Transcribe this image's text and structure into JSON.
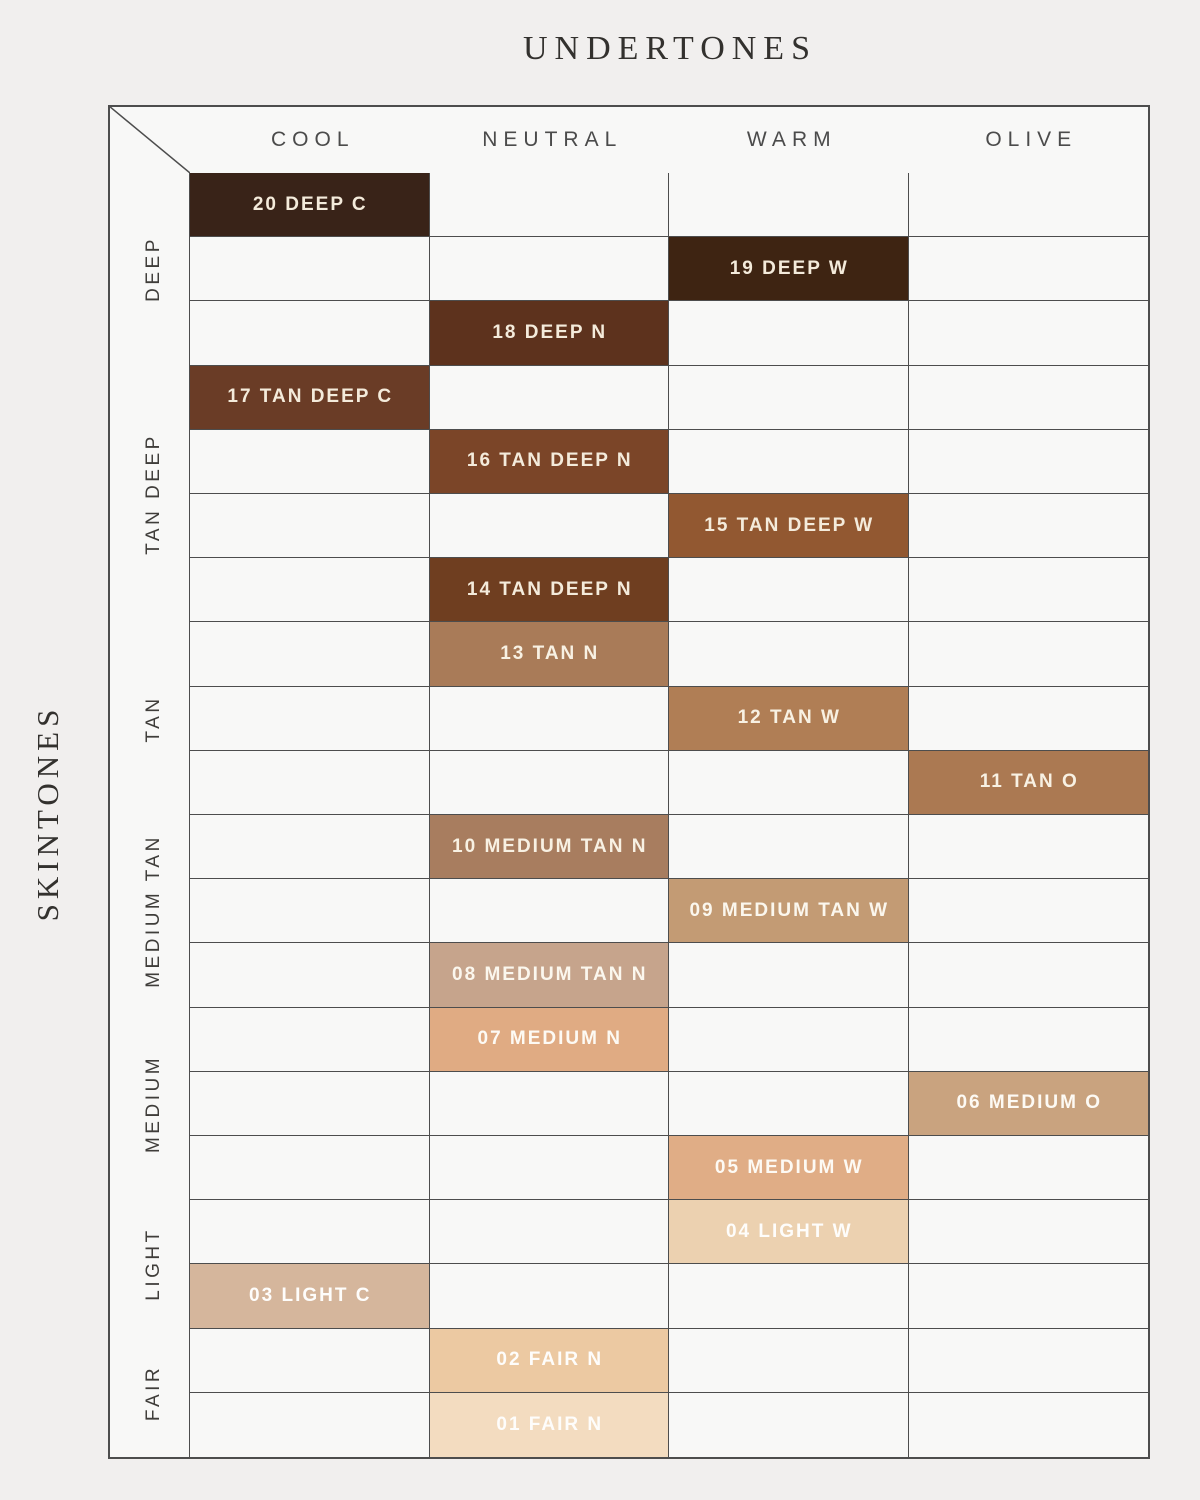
{
  "page": {
    "title": "UNDERTONES",
    "side_title": "SKINTONES"
  },
  "undertones": [
    "COOL",
    "NEUTRAL",
    "WARM",
    "OLIVE"
  ],
  "skintone_groups": [
    {
      "label": "DEEP",
      "rows": 3
    },
    {
      "label": "TAN DEEP",
      "rows": 4
    },
    {
      "label": "TAN",
      "rows": 3
    },
    {
      "label": "MEDIUM TAN",
      "rows": 3
    },
    {
      "label": "MEDIUM",
      "rows": 3
    },
    {
      "label": "LIGHT",
      "rows": 2
    },
    {
      "label": "FAIR",
      "rows": 2
    }
  ],
  "chart_data": {
    "type": "table",
    "title": "UNDERTONES",
    "column_axis_label": "UNDERTONES",
    "row_axis_label": "SKINTONES",
    "columns": [
      "COOL",
      "NEUTRAL",
      "WARM",
      "OLIVE"
    ],
    "row_groups": [
      "DEEP",
      "TAN DEEP",
      "TAN",
      "MEDIUM TAN",
      "MEDIUM",
      "LIGHT",
      "FAIR"
    ],
    "cells": [
      {
        "shade": "20 DEEP C",
        "skintone": "DEEP",
        "undertone": "COOL",
        "swatch": "#392318",
        "label_color": "#f4ebdb"
      },
      {
        "shade": "19 DEEP W",
        "skintone": "DEEP",
        "undertone": "WARM",
        "swatch": "#3e2412",
        "label_color": "#f4ebdb"
      },
      {
        "shade": "18 DEEP N",
        "skintone": "DEEP",
        "undertone": "NEUTRAL",
        "swatch": "#5d321d",
        "label_color": "#f4ebdb"
      },
      {
        "shade": "17 TAN DEEP C",
        "skintone": "TAN DEEP",
        "undertone": "COOL",
        "swatch": "#6a3c26",
        "label_color": "#f4ebdb"
      },
      {
        "shade": "16 TAN DEEP N",
        "skintone": "TAN DEEP",
        "undertone": "NEUTRAL",
        "swatch": "#7b4528",
        "label_color": "#f4ebdb"
      },
      {
        "shade": "15 TAN DEEP W",
        "skintone": "TAN DEEP",
        "undertone": "WARM",
        "swatch": "#925831",
        "label_color": "#f4ebdb"
      },
      {
        "shade": "14 TAN DEEP N",
        "skintone": "TAN DEEP",
        "undertone": "NEUTRAL",
        "swatch": "#6f3e20",
        "label_color": "#f4ebdb"
      },
      {
        "shade": "13 TAN N",
        "skintone": "TAN",
        "undertone": "NEUTRAL",
        "swatch": "#a97b58",
        "label_color": "#f8f1e3"
      },
      {
        "shade": "12 TAN W",
        "skintone": "TAN",
        "undertone": "WARM",
        "swatch": "#b07e55",
        "label_color": "#f8f1e3"
      },
      {
        "shade": "11 TAN O",
        "skintone": "TAN",
        "undertone": "OLIVE",
        "swatch": "#ab7952",
        "label_color": "#f8f1e3"
      },
      {
        "shade": "10 MEDIUM TAN N",
        "skintone": "MEDIUM TAN",
        "undertone": "NEUTRAL",
        "swatch": "#a87d5f",
        "label_color": "#f8f1e3"
      },
      {
        "shade": "09 MEDIUM TAN W",
        "skintone": "MEDIUM TAN",
        "undertone": "WARM",
        "swatch": "#c39b74",
        "label_color": "#fbf7ee"
      },
      {
        "shade": "08 MEDIUM TAN N",
        "skintone": "MEDIUM TAN",
        "undertone": "NEUTRAL",
        "swatch": "#c6a48c",
        "label_color": "#fbf7ee"
      },
      {
        "shade": "07 MEDIUM N",
        "skintone": "MEDIUM",
        "undertone": "NEUTRAL",
        "swatch": "#e0ab83",
        "label_color": "#fdfaf4"
      },
      {
        "shade": "06 MEDIUM O",
        "skintone": "MEDIUM",
        "undertone": "OLIVE",
        "swatch": "#c9a37f",
        "label_color": "#fdfaf4"
      },
      {
        "shade": "05 MEDIUM W",
        "skintone": "MEDIUM",
        "undertone": "WARM",
        "swatch": "#e0ad86",
        "label_color": "#fdfaf4"
      },
      {
        "shade": "04 LIGHT W",
        "skintone": "LIGHT",
        "undertone": "WARM",
        "swatch": "#ecd1b0",
        "label_color": "#fefdfb"
      },
      {
        "shade": "03 LIGHT C",
        "skintone": "LIGHT",
        "undertone": "COOL",
        "swatch": "#d5b69c",
        "label_color": "#fefdfb"
      },
      {
        "shade": "02 FAIR N",
        "skintone": "FAIR",
        "undertone": "NEUTRAL",
        "swatch": "#ecc9a2",
        "label_color": "#fefdfb"
      },
      {
        "shade": "01 FAIR N",
        "skintone": "FAIR",
        "undertone": "NEUTRAL",
        "swatch": "#f3dcc0",
        "label_color": "#fefdfb"
      }
    ]
  },
  "style": {
    "page_bg": "#f1efee",
    "cell_bg": "#f8f8f7",
    "grid_line_color": "#4d4d4d",
    "heading_color": "#33312e",
    "header_color": "#4b4b4b",
    "group_label_color": "#3f3d3a"
  }
}
